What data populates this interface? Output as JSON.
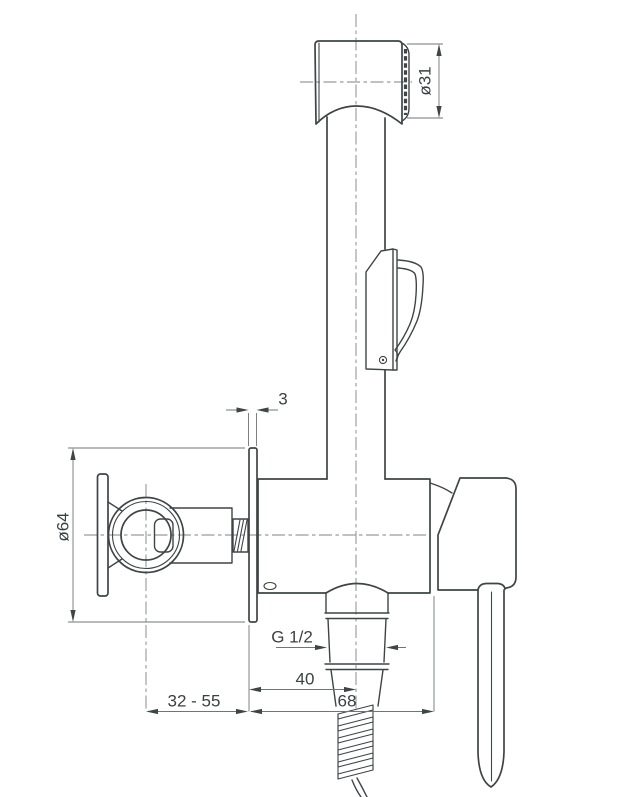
{
  "dimensions": {
    "spray_face_diameter": "ø31",
    "rosette_thickness": "3",
    "rosette_diameter": "ø64",
    "thread_size": "G 1/2",
    "outlet_center_offset": "40",
    "body_projection": "68",
    "mounting_depth_range": "32 - 55"
  },
  "colors": {
    "background": "#ffffff",
    "main_line": "#3f4446",
    "thin_line": "#6f7476",
    "centerline": "#7e8385",
    "text": "#3b4043"
  }
}
